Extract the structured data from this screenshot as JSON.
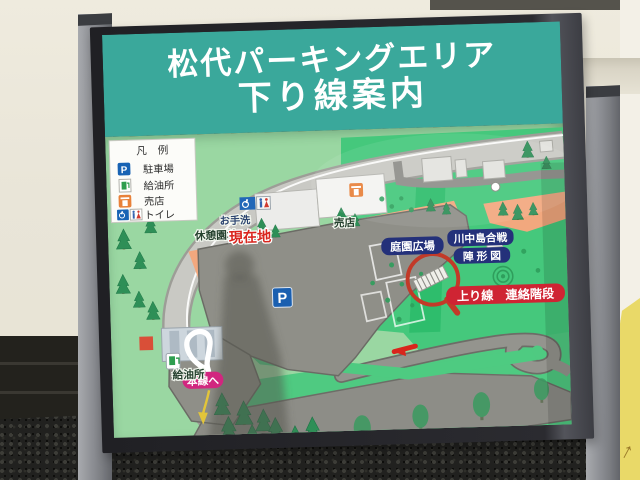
{
  "sign": {
    "title_line1": "松代パーキングエリア",
    "title_line2": "下り線案内",
    "legend": {
      "title": "凡　例",
      "items": [
        {
          "icon": "parking-icon",
          "symbol": "P",
          "label": "駐車場"
        },
        {
          "icon": "fuel-pump-icon",
          "label": "給油所"
        },
        {
          "icon": "shop-icon",
          "label": "売店"
        },
        {
          "icon": "toilet-icon",
          "label": "トイレ"
        }
      ]
    },
    "map": {
      "rest_garden_label": "休憩園地",
      "restroom_label": "お手洗",
      "current_location_label": "現在地",
      "shop_label": "売店",
      "garden_plaza_label": "庭園広場",
      "battle_map_label_line1": "川中島合戦",
      "battle_map_label_line2": "陣 形 図",
      "up_line_stairs_label": "上り線　連絡階段",
      "parking_symbol": "P",
      "gas_station_label": "給油所",
      "to_main_line_label": "本線へ"
    },
    "colors": {
      "header_teal": "#3aa89b",
      "map_green_light": "#9ad7a2",
      "map_green_bright": "#45c87c",
      "road_grey": "#8d8d87",
      "walkway_orange": "#f2a87e",
      "badge_navy": "#24317a",
      "badge_red": "#cf2433",
      "badge_magenta": "#d1267f",
      "current_location_red": "#d9251d",
      "parking_sign_blue": "#1a5fb0"
    }
  }
}
